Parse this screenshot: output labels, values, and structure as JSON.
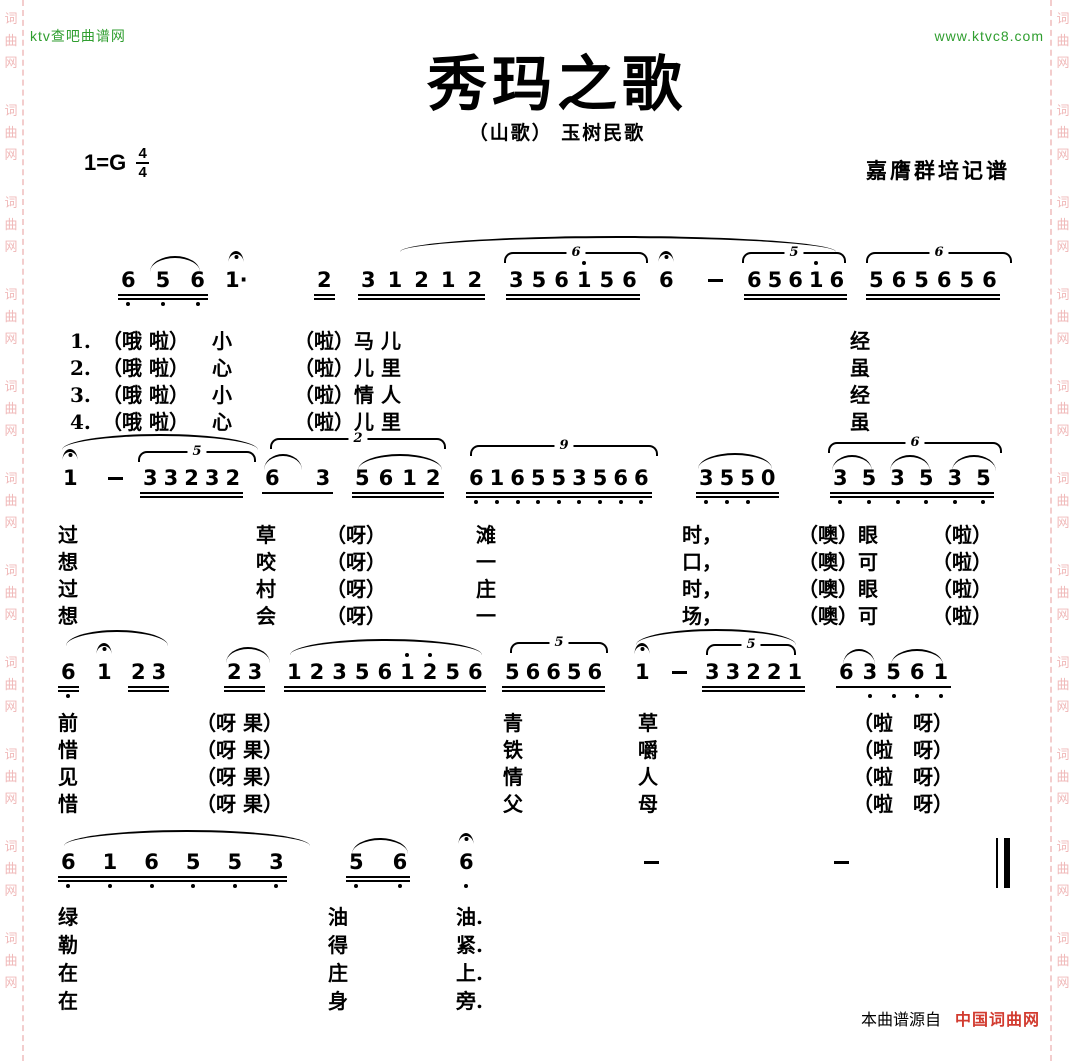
{
  "branding": {
    "top_left": "ktv查吧曲谱网",
    "top_right": "www.ktvc8.com",
    "side_watermark": "词曲网",
    "footer_source_prefix": "本曲谱源自",
    "footer_source_site": "中国词曲网"
  },
  "colors": {
    "site_green": "#2f9e2f",
    "watermark_pink": "#f0b9b9",
    "footer_red": "#d23b2f",
    "ink_black": "#000000",
    "paper_white": "#ffffff"
  },
  "score": {
    "title": "秀玛之歌",
    "subtitle": "（山歌） 玉树民歌",
    "key": "1=G",
    "meter_top": "4",
    "meter_bottom": "4",
    "transcriber": "嘉膺群培记谱",
    "systems": [
      {
        "top": 268,
        "lyricTop": 60,
        "rowH": 27,
        "groups": [
          {
            "x": 118,
            "g": 14,
            "beams": 2,
            "notes": [
              {
                "t": "6",
                "lo": 1
              },
              {
                "t": "5",
                "lo": 1
              },
              {
                "t": "6",
                "lo": 1
              }
            ]
          },
          {
            "x": 222,
            "beams": 0,
            "notes": [
              {
                "t": "1",
                "ad": 1,
                "ferm": 1
              }
            ]
          },
          {
            "x": 314,
            "beams": 2,
            "notes": [
              {
                "t": "2"
              }
            ]
          },
          {
            "x": 358,
            "g": 6,
            "beams": 2,
            "notes": [
              {
                "t": "3"
              },
              {
                "t": "1"
              },
              {
                "t": "2"
              },
              {
                "t": "1"
              },
              {
                "t": "2"
              }
            ]
          },
          {
            "x": 506,
            "g": 2,
            "beams": 2,
            "notes": [
              {
                "t": "3"
              },
              {
                "t": "5"
              },
              {
                "t": "6"
              },
              {
                "t": "1",
                "hi": 1
              },
              {
                "t": "5"
              },
              {
                "t": "6"
              }
            ]
          },
          {
            "x": 656,
            "beams": 0,
            "notes": [
              {
                "t": "6",
                "ferm": 1
              }
            ]
          },
          {
            "x": 704,
            "beams": 0,
            "notes": [
              {
                "t": "–",
                "dash": 1
              }
            ]
          },
          {
            "x": 744,
            "g": 0,
            "beams": 2,
            "notes": [
              {
                "t": "6"
              },
              {
                "t": "5"
              },
              {
                "t": "6"
              },
              {
                "t": "1",
                "hi": 1
              },
              {
                "t": "6"
              }
            ]
          },
          {
            "x": 866,
            "g": 2,
            "beams": 2,
            "notes": [
              {
                "t": "5"
              },
              {
                "t": "6"
              },
              {
                "t": "5"
              },
              {
                "t": "6"
              },
              {
                "t": "5"
              },
              {
                "t": "6"
              }
            ]
          }
        ],
        "arcs": [
          {
            "x": 150,
            "y": -12,
            "w": 50,
            "type": "slur"
          },
          {
            "x": 400,
            "y": -32,
            "w": 436,
            "type": "slur"
          },
          {
            "x": 504,
            "y": -16,
            "w": 140,
            "type": "tuplet",
            "label": "6"
          },
          {
            "x": 742,
            "y": -16,
            "w": 100,
            "type": "tuplet",
            "label": "5"
          },
          {
            "x": 866,
            "y": -16,
            "w": 142,
            "type": "tuplet",
            "label": "6"
          }
        ],
        "lyrics": [
          {
            "x": 70,
            "lines": [
              "1.",
              "2.",
              "3.",
              "4."
            ]
          },
          {
            "x": 102,
            "lines": [
              "（哦 啦）",
              "（哦 啦）",
              "（哦 啦）",
              "（哦 啦）"
            ]
          },
          {
            "x": 212,
            "lines": [
              "小",
              "心",
              "小",
              "心"
            ]
          },
          {
            "x": 294,
            "lines": [
              "（啦）马 儿",
              "（啦）儿 里",
              "（啦）情 人",
              "（啦）儿 里"
            ]
          },
          {
            "x": 850,
            "lines": [
              "经",
              "虽",
              "经",
              "虽"
            ]
          }
        ]
      },
      {
        "top": 466,
        "lyricTop": 56,
        "rowH": 27,
        "groups": [
          {
            "x": 60,
            "beams": 0,
            "notes": [
              {
                "t": "1",
                "ferm": 1
              }
            ]
          },
          {
            "x": 104,
            "beams": 0,
            "notes": [
              {
                "t": "–",
                "dash": 1
              }
            ]
          },
          {
            "x": 140,
            "g": 0,
            "beams": 2,
            "notes": [
              {
                "t": "3"
              },
              {
                "t": "3"
              },
              {
                "t": "2"
              },
              {
                "t": "3"
              },
              {
                "t": "2"
              }
            ]
          },
          {
            "x": 262,
            "g": 30,
            "beams": 1,
            "notes": [
              {
                "t": "6"
              },
              {
                "t": "3"
              }
            ]
          },
          {
            "x": 352,
            "g": 3,
            "beams": 2,
            "notes": [
              {
                "t": "5"
              },
              {
                "t": "6"
              },
              {
                "t": "1"
              },
              {
                "t": "2"
              }
            ]
          },
          {
            "x": 466,
            "g": 0,
            "beams": 2,
            "notes": [
              {
                "t": "6",
                "lo": 1
              },
              {
                "t": "1",
                "lo": 1
              },
              {
                "t": "6",
                "lo": 1
              },
              {
                "t": "5",
                "lo": 1
              },
              {
                "t": "5",
                "lo": 1
              },
              {
                "t": "3",
                "lo": 1
              },
              {
                "t": "5",
                "lo": 1
              },
              {
                "t": "6",
                "lo": 1
              },
              {
                "t": "6",
                "lo": 1
              }
            ]
          },
          {
            "x": 696,
            "g": 0,
            "beams": 2,
            "notes": [
              {
                "t": "3",
                "lo": 1
              },
              {
                "t": "5",
                "lo": 1
              },
              {
                "t": "5",
                "lo": 1
              },
              {
                "t": "0"
              }
            ]
          },
          {
            "x": 830,
            "g": 8,
            "beams": 2,
            "notes": [
              {
                "t": "3",
                "lo": 1
              },
              {
                "t": "5",
                "lo": 1
              },
              {
                "t": "3",
                "lo": 1
              },
              {
                "t": "5",
                "lo": 1
              },
              {
                "t": "3",
                "lo": 1
              },
              {
                "t": "5",
                "lo": 1
              }
            ]
          }
        ],
        "arcs": [
          {
            "x": 62,
            "y": -32,
            "w": 196,
            "type": "slur"
          },
          {
            "x": 138,
            "y": -15,
            "w": 114,
            "type": "tuplet",
            "label": "5"
          },
          {
            "x": 264,
            "y": -12,
            "w": 38,
            "type": "slur"
          },
          {
            "x": 270,
            "y": -28,
            "w": 172,
            "type": "tuplet",
            "label": "2"
          },
          {
            "x": 358,
            "y": -12,
            "w": 84,
            "type": "slur"
          },
          {
            "x": 470,
            "y": -21,
            "w": 184,
            "type": "tuplet",
            "label": "9"
          },
          {
            "x": 698,
            "y": -13,
            "w": 74,
            "type": "slur"
          },
          {
            "x": 828,
            "y": -24,
            "w": 170,
            "type": "tuplet",
            "label": "6"
          },
          {
            "x": 832,
            "y": -11,
            "w": 40,
            "type": "slur"
          },
          {
            "x": 890,
            "y": -11,
            "w": 40,
            "type": "slur"
          },
          {
            "x": 952,
            "y": -11,
            "w": 44,
            "type": "slur"
          }
        ],
        "lyrics": [
          {
            "x": 58,
            "lines": [
              "过",
              "想",
              "过",
              "想"
            ]
          },
          {
            "x": 256,
            "lines": [
              "草",
              "咬",
              "村",
              "会"
            ]
          },
          {
            "x": 326,
            "lines": [
              "（呀）",
              "（呀）",
              "（呀）",
              "（呀）"
            ]
          },
          {
            "x": 476,
            "lines": [
              "滩",
              "一",
              "庄",
              "一"
            ]
          },
          {
            "x": 682,
            "lines": [
              "时，",
              "口，",
              "时，",
              "场，"
            ]
          },
          {
            "x": 798,
            "lines": [
              "（噢）眼",
              "（噢）可",
              "（噢）眼",
              "（噢）可"
            ]
          },
          {
            "x": 932,
            "lines": [
              "（啦）",
              "（啦）",
              "（啦）",
              "（啦）"
            ]
          }
        ]
      },
      {
        "top": 660,
        "lyricTop": 50,
        "rowH": 27,
        "groups": [
          {
            "x": 58,
            "beams": 2,
            "notes": [
              {
                "t": "6",
                "lo": 1
              }
            ]
          },
          {
            "x": 94,
            "beams": 0,
            "notes": [
              {
                "t": "1",
                "ferm": 1
              }
            ]
          },
          {
            "x": 128,
            "g": 0,
            "beams": 2,
            "notes": [
              {
                "t": "2"
              },
              {
                "t": "3"
              }
            ]
          },
          {
            "x": 224,
            "g": 0,
            "beams": 2,
            "notes": [
              {
                "t": "2"
              },
              {
                "t": "3"
              }
            ]
          },
          {
            "x": 284,
            "g": 2,
            "beams": 2,
            "notes": [
              {
                "t": "1"
              },
              {
                "t": "2"
              },
              {
                "t": "3"
              },
              {
                "t": "5"
              },
              {
                "t": "6"
              },
              {
                "t": "1",
                "hi": 1
              },
              {
                "t": "2",
                "hi": 1
              },
              {
                "t": "5"
              },
              {
                "t": "6"
              }
            ]
          },
          {
            "x": 502,
            "g": 0,
            "beams": 2,
            "notes": [
              {
                "t": "5"
              },
              {
                "t": "6"
              },
              {
                "t": "6"
              },
              {
                "t": "5"
              },
              {
                "t": "6"
              }
            ]
          },
          {
            "x": 632,
            "beams": 0,
            "notes": [
              {
                "t": "1",
                "ferm": 1
              }
            ]
          },
          {
            "x": 668,
            "beams": 0,
            "notes": [
              {
                "t": "–",
                "dash": 1
              }
            ]
          },
          {
            "x": 702,
            "g": 0,
            "beams": 2,
            "notes": [
              {
                "t": "3"
              },
              {
                "t": "3"
              },
              {
                "t": "2"
              },
              {
                "t": "2"
              },
              {
                "t": "1"
              }
            ]
          },
          {
            "x": 836,
            "g": 3,
            "beams": 1,
            "notes": [
              {
                "t": "6"
              },
              {
                "t": "3",
                "lo": 1
              },
              {
                "t": "5",
                "lo": 1
              },
              {
                "t": "6",
                "lo": 1
              },
              {
                "t": "1",
                "lo": 1
              }
            ]
          }
        ],
        "arcs": [
          {
            "x": 66,
            "y": -30,
            "w": 102,
            "type": "slur"
          },
          {
            "x": 226,
            "y": -13,
            "w": 44,
            "type": "slur"
          },
          {
            "x": 290,
            "y": -21,
            "w": 192,
            "type": "slur"
          },
          {
            "x": 510,
            "y": -18,
            "w": 94,
            "type": "tuplet",
            "label": "5"
          },
          {
            "x": 636,
            "y": -31,
            "w": 160,
            "type": "slur"
          },
          {
            "x": 706,
            "y": -16,
            "w": 86,
            "type": "tuplet",
            "label": "5"
          },
          {
            "x": 843,
            "y": -11,
            "w": 32,
            "type": "slur"
          },
          {
            "x": 891,
            "y": -11,
            "w": 52,
            "type": "slur"
          }
        ],
        "lyrics": [
          {
            "x": 58,
            "lines": [
              "前",
              "惜",
              "见",
              "惜"
            ]
          },
          {
            "x": 196,
            "lines": [
              "（呀 果）",
              "（呀 果）",
              "（呀 果）",
              "（呀 果）"
            ]
          },
          {
            "x": 503,
            "lines": [
              "青",
              "铁",
              "情",
              "父"
            ]
          },
          {
            "x": 638,
            "lines": [
              "草",
              "嚼",
              "人",
              "母"
            ]
          },
          {
            "x": 853,
            "lines": [
              "（啦　呀）",
              "（啦　呀）",
              "（啦　呀）",
              "（啦　呀）"
            ]
          }
        ]
      },
      {
        "top": 850,
        "lyricTop": 53,
        "rowH": 28,
        "finalBarX": 996,
        "groups": [
          {
            "x": 58,
            "g": 21,
            "beams": 2,
            "notes": [
              {
                "t": "6",
                "lo": 1
              },
              {
                "t": "1",
                "lo": 1
              },
              {
                "t": "6",
                "lo": 1
              },
              {
                "t": "5",
                "lo": 1
              },
              {
                "t": "5",
                "lo": 1
              },
              {
                "t": "3",
                "lo": 1
              }
            ]
          },
          {
            "x": 346,
            "g": 23,
            "beams": 2,
            "notes": [
              {
                "t": "5",
                "lo": 1
              },
              {
                "t": "6",
                "lo": 1
              }
            ]
          },
          {
            "x": 456,
            "beams": 0,
            "notes": [
              {
                "t": "6",
                "ferm": 1,
                "lo": 1
              }
            ]
          },
          {
            "x": 640,
            "beams": 0,
            "notes": [
              {
                "t": "–",
                "dash": 1
              }
            ]
          },
          {
            "x": 830,
            "beams": 0,
            "notes": [
              {
                "t": "–",
                "dash": 1
              }
            ]
          }
        ],
        "arcs": [
          {
            "x": 64,
            "y": -20,
            "w": 246,
            "type": "slur"
          },
          {
            "x": 352,
            "y": -12,
            "w": 56,
            "type": "slur"
          }
        ],
        "lyrics": [
          {
            "x": 58,
            "lines": [
              "绿",
              "勒",
              "在",
              "在"
            ]
          },
          {
            "x": 328,
            "lines": [
              "油",
              "得",
              "庄",
              "身"
            ]
          },
          {
            "x": 456,
            "lines": [
              "油.",
              "紧.",
              "上.",
              "旁."
            ]
          }
        ]
      }
    ]
  }
}
